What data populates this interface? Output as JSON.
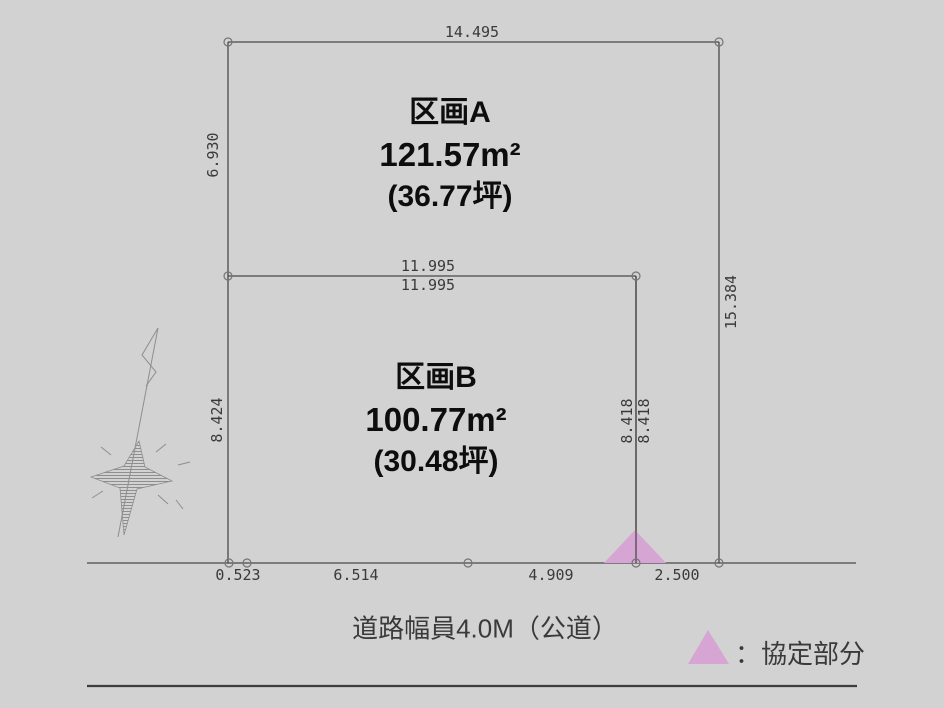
{
  "colors": {
    "background": "#d2d2d2",
    "line": "#4a4a4a",
    "dim_text": "#3a3a3a",
    "label_text": "#0d0d0d",
    "agreement_triangle": "#d6a5d4",
    "north_arrow": "#8e8e8e"
  },
  "plots": {
    "a": {
      "name": "区画A",
      "area_m2": "121.57m²",
      "area_tsubo": "(36.77坪)"
    },
    "b": {
      "name": "区画B",
      "area_m2": "100.77m²",
      "area_tsubo": "(30.48坪)"
    }
  },
  "dimensions": {
    "top": "14.495",
    "left_upper": "6.930",
    "right": "15.384",
    "divider_upper": "11.995",
    "divider_lower": "11.995",
    "left_lower": "8.424",
    "plot_b_right_inner": "8.418",
    "plot_b_right_outer": "8.418",
    "bottom": [
      "0.523",
      "6.514",
      "4.909",
      "2.500"
    ]
  },
  "road": {
    "label": "道路幅員4.0M（公道）"
  },
  "legend": {
    "label": "：協定部分"
  }
}
